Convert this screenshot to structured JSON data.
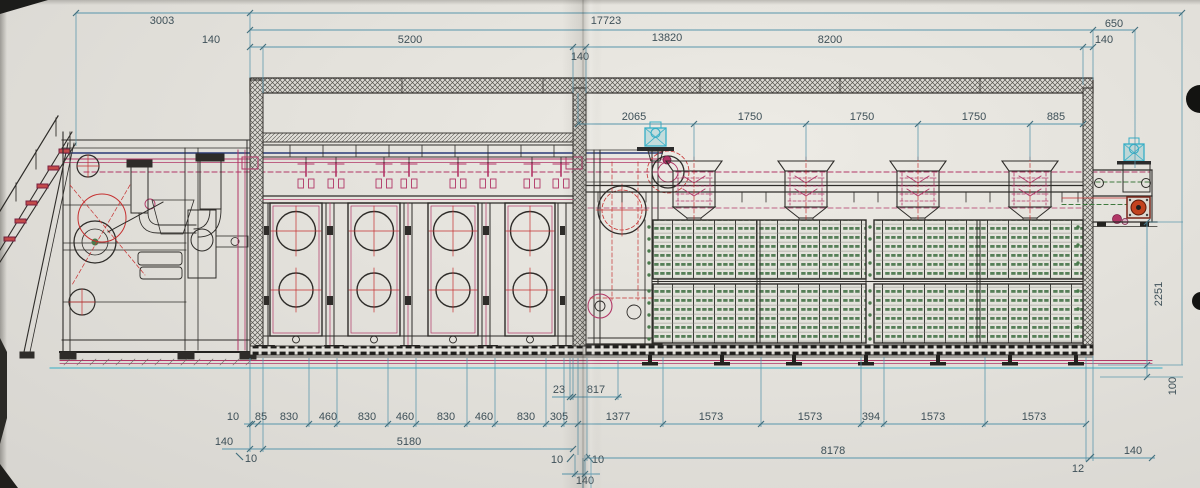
{
  "drawing": {
    "title_hint": "machine line side elevation",
    "dims": {
      "d3003": "3003",
      "d17723": "17723",
      "d13820": "13820",
      "d650": "650",
      "d140_a": "140",
      "d5200": "5200",
      "d140_b": "140",
      "d8200": "8200",
      "d140_c": "140",
      "d2065": "2065",
      "d1750_a": "1750",
      "d1750_b": "1750",
      "d1750_c": "1750",
      "d885": "885",
      "d2251": "2251",
      "d100": "100",
      "d23": "23",
      "d817": "817",
      "d10": "10",
      "d85": "85",
      "d830_a": "830",
      "d460_a": "460",
      "d830_b": "830",
      "d460_b": "460",
      "d830_c": "830",
      "d460_c": "460",
      "d830_d": "830",
      "d305": "305",
      "d1377": "1377",
      "d1573_a": "1573",
      "d1573_b": "1573",
      "d394": "394",
      "d1573_c": "1573",
      "d1573_d": "1573",
      "d140_base": "140",
      "d5180": "5180",
      "d8178": "8178",
      "d10_ga": "10",
      "d10_gb": "10",
      "d10_gc": "10",
      "d140_mid": "140",
      "d12": "12",
      "d140_right": "140"
    },
    "palette": {
      "paper": "#e3e1db",
      "dimension_line": "#5795ab",
      "dimension_text": "#3e5058",
      "outline": "#2e2c29",
      "magenta": "#b13666",
      "red": "#c53030",
      "cyan": "#35aec6",
      "navy": "#2a3a78",
      "mesh_green": "#557f57"
    }
  }
}
